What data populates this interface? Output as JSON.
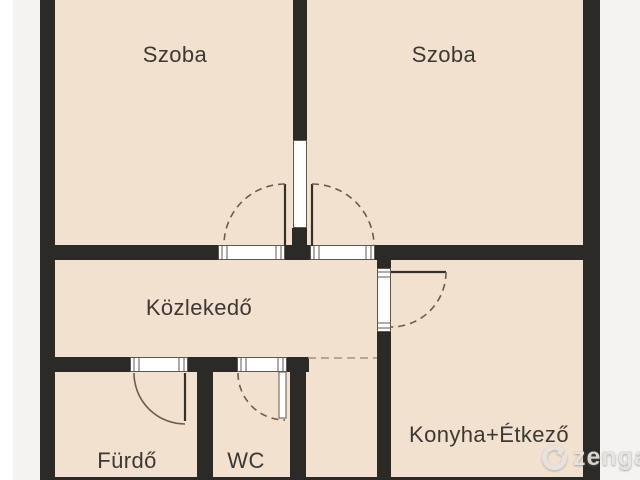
{
  "plan": {
    "type": "apartment-floor-plan",
    "rooms": [
      {
        "id": "szoba-left",
        "label": "Szoba"
      },
      {
        "id": "szoba-right",
        "label": "Szoba"
      },
      {
        "id": "kozlekedo",
        "label": "Közlekedő"
      },
      {
        "id": "furdo",
        "label": "Fürdő"
      },
      {
        "id": "wc",
        "label": "WC"
      },
      {
        "id": "konyha-etkezo",
        "label": "Konyha+Étkező"
      }
    ],
    "door_count": 5,
    "open_passage_count": 1
  },
  "watermark": {
    "brand": "zenga",
    "icon": "zenga-logo"
  },
  "colors": {
    "wall": "#2b2a26",
    "room_fill": "#f3e1d0",
    "outside": "#f4f3f1",
    "door_line": "#6f5b46",
    "opening_outline": "#5d594f",
    "label_text": "#3b3933",
    "watermark": "#e6e3df"
  }
}
